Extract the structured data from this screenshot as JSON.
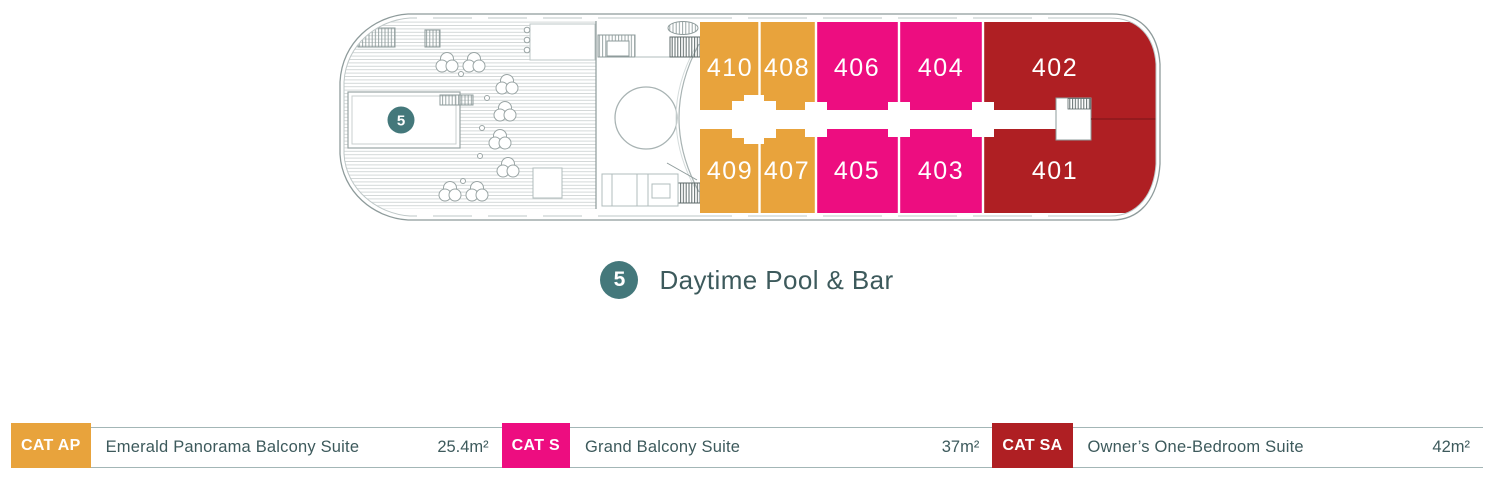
{
  "feature": {
    "marker": "5",
    "label": "Daytime Pool & Bar"
  },
  "deck": {
    "cabins": [
      {
        "number": "410",
        "category": "CAT AP"
      },
      {
        "number": "408",
        "category": "CAT AP"
      },
      {
        "number": "406",
        "category": "CAT S"
      },
      {
        "number": "404",
        "category": "CAT S"
      },
      {
        "number": "402",
        "category": "CAT SA"
      },
      {
        "number": "409",
        "category": "CAT AP"
      },
      {
        "number": "407",
        "category": "CAT AP"
      },
      {
        "number": "405",
        "category": "CAT S"
      },
      {
        "number": "403",
        "category": "CAT S"
      },
      {
        "number": "401",
        "category": "CAT SA"
      }
    ]
  },
  "legend": {
    "items": [
      {
        "code": "CAT AP",
        "name": "Emerald Panorama Balcony Suite",
        "size": "25.4m²",
        "color": "#E8A33C"
      },
      {
        "code": "CAT S",
        "name": "Grand Balcony Suite",
        "size": "37m²",
        "color": "#ED0D80"
      },
      {
        "code": "CAT SA",
        "name": "Owner’s One-Bedroom Suite",
        "size": "42m²",
        "color": "#AF1F23"
      }
    ]
  },
  "colors": {
    "marker_teal": "#44787B",
    "text": "#3D5A5C",
    "hull_line": "#8E9B9B"
  }
}
